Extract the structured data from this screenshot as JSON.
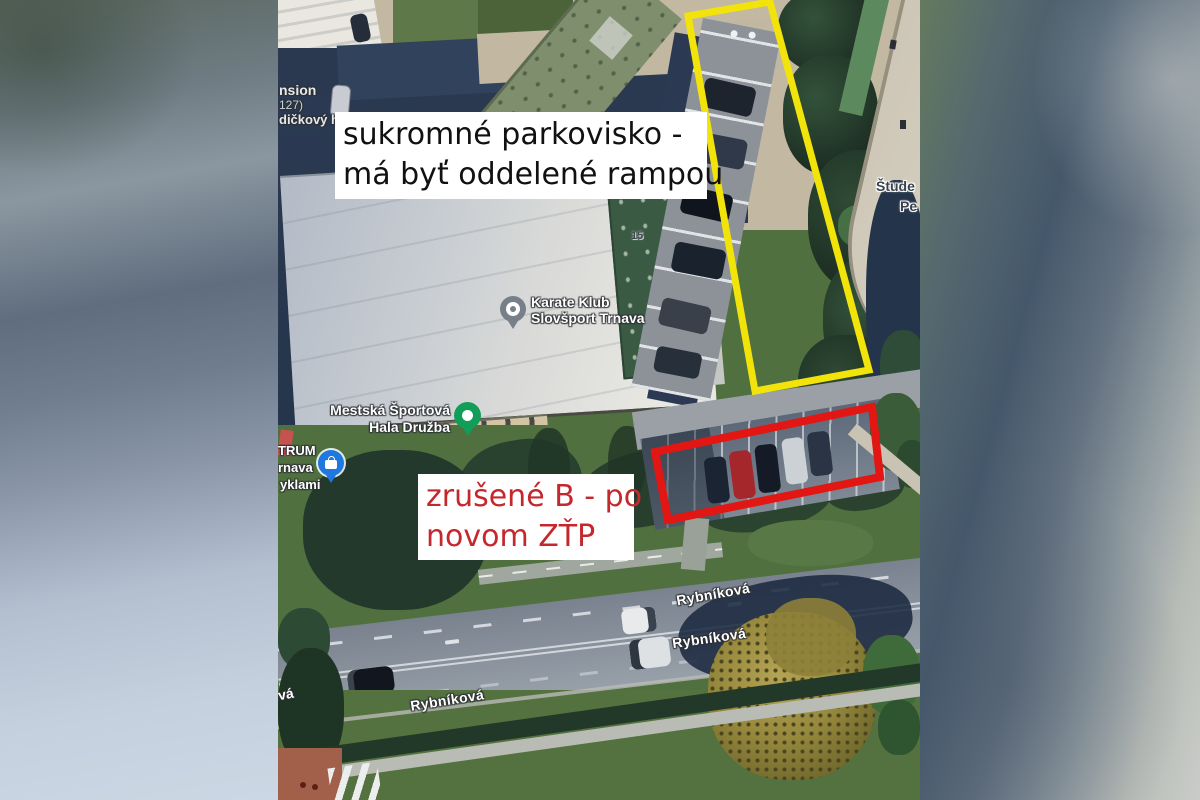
{
  "notes": {
    "parking": {
      "lines": [
        "sukromné parkovisko -",
        "má byť oddelené rampou"
      ],
      "text_color": "#111111",
      "bg": "#ffffff"
    },
    "cancelled": {
      "lines": [
        "zrušené B - po",
        "novom ZŤP"
      ],
      "text_color": "#c4282c",
      "bg": "#ffffff"
    }
  },
  "highlights": {
    "yellow_box": {
      "points": "410,16 492,2 591,370 477,391",
      "color": "#f2e40b"
    },
    "red_box": {
      "points": "377,452 594,407 602,477 390,520",
      "color": "#e21613"
    }
  },
  "map_labels": {
    "karate": {
      "line1": "Karate Klub",
      "line2": "Slovšport Trnava"
    },
    "hala": {
      "line1": "Mestská Športová",
      "line2": "Hala Družba"
    },
    "street1": "Rybníková",
    "street2": "Rybníková",
    "street3": "Rybníková",
    "street_clipped": "vá",
    "stude_line1": "Štude",
    "stude_line2": "Pe",
    "pension_line1": "nsion",
    "pension_line2": "127)",
    "pension_line3": "dičkový hote",
    "centrum_line1": "TRUM",
    "centrum_line2": "rnava",
    "centrum_line3": "yklami",
    "building_no": "15"
  },
  "icons": {
    "karate_pin": "place-pin-gray",
    "hala_pin": "place-pin-green",
    "shopping_pin": "shopping-bag-pin-blue"
  },
  "colors": {
    "highlight_yellow": "#f2e40b",
    "highlight_red": "#e21613",
    "note_red_text": "#c4282c",
    "pin_gray": "#777f89",
    "pin_green": "#129e58",
    "pin_blue": "#1f78e0"
  }
}
